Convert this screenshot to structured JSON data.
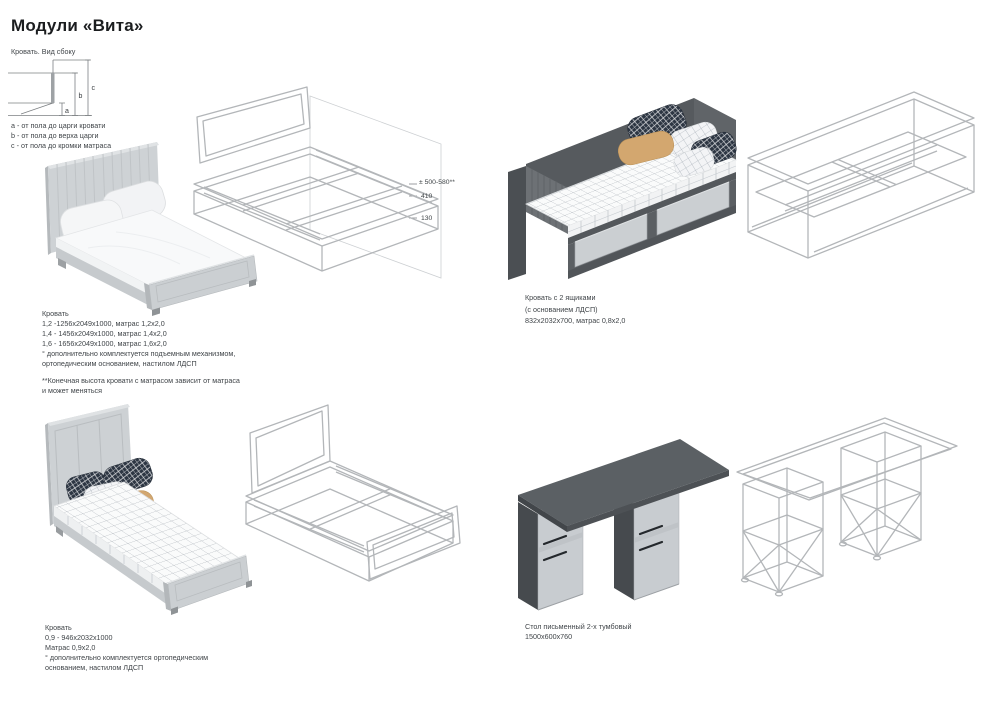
{
  "page_title": "Модули «Вита»",
  "palette": {
    "background": "#ffffff",
    "title_text": "#1b1d1f",
    "body_text": "#404549",
    "wireframe_line": "#b3b6b9",
    "furniture_light_grey": "#ced2d5",
    "furniture_dark_grey": "#565a5e",
    "drawer_front_grey": "#cbcfd2",
    "pillow_navy": "#2d3643",
    "pillow_tan": "#d3a76f"
  },
  "side_view": {
    "label": "Кровать. Вид сбоку",
    "dims": [
      "a",
      "b",
      "c"
    ],
    "legend": [
      "a - от пола до царги кровати",
      "b - от пола до верха царги",
      "c - от пола до кромки матраса"
    ]
  },
  "bed_double": {
    "wireframe_dims": [
      "± 500-580**",
      "410",
      "130"
    ],
    "lines": [
      "Кровать",
      "1,2 -1256х2049х1000, матрас 1,2х2,0",
      "1,4 - 1456х2049х1000, матрас 1,4х2,0",
      "1,6 - 1656х2049х1000, матрас 1,6х2,0",
      "° дополнительно комплектуется подъемным механизмом,",
      "ортопедическим основанием, настилом ЛДСП"
    ],
    "footnote": [
      "**Конечная высота кровати с матрасом зависит от матраса",
      "и может меняться"
    ]
  },
  "bed_drawers": {
    "lines": [
      "Кровать с 2 ящиками",
      "(с основанием ЛДСП)",
      "832х2032х700, матрас 0,8х2,0"
    ]
  },
  "bed_single": {
    "lines": [
      "Кровать",
      "0,9 - 946х2032х1000",
      "Матрас 0,9х2,0",
      "° дополнительно комплектуется ортопедическим",
      "основанием, настилом ЛДСП"
    ]
  },
  "desk": {
    "lines": [
      "Стол письменный 2-х тумбовый",
      "1500х600х760"
    ]
  }
}
